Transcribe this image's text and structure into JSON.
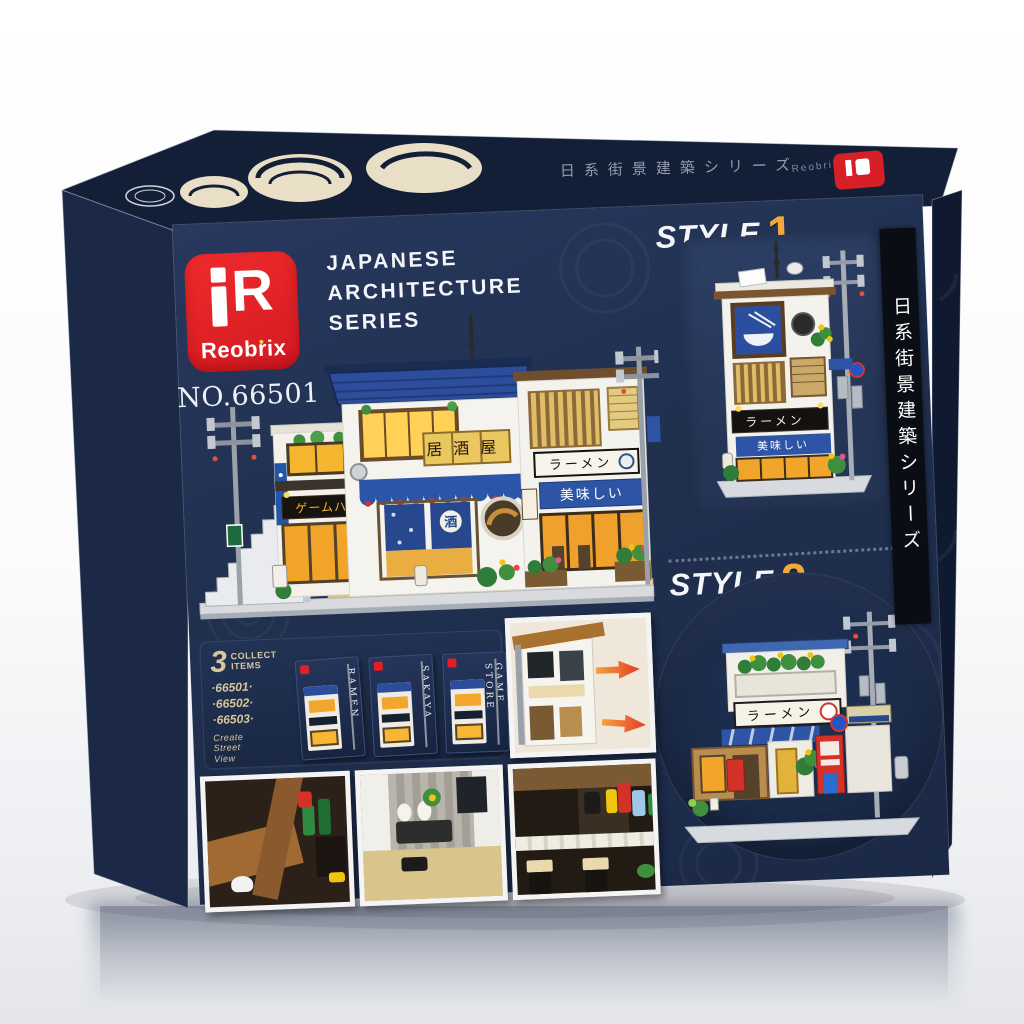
{
  "product": {
    "brand": "Reobrix",
    "logo_mark": "R",
    "product_no": "NO.66501",
    "series_title": "JAPANESE\nARCHITECTURE\nSERIES",
    "side_strip_text": "日系街景建築シリーズ",
    "lid_text": "日系街景建築シリーズ",
    "lid_brand": "Reobrix"
  },
  "styles": {
    "style1": {
      "label": "STYLE",
      "number": "1",
      "subtitle": "モデリング"
    },
    "style2": {
      "label": "STYLE",
      "number": "2",
      "subtitle": "モデリング"
    }
  },
  "signs": {
    "izakaya": "居酒屋",
    "ramen": "ラーメン",
    "oishii": "美味しい",
    "game_house": "ゲームハウス",
    "sake": "酒",
    "style1_ramen": "ラーメン",
    "style1_oishii": "美味しい",
    "style2_ramen": "ラーメン"
  },
  "collect": {
    "count": "3",
    "label": "COLLECT\nITEMS",
    "numbers": [
      "·66501·",
      "·66502·",
      "·66503·"
    ],
    "tagline": "Create\nStreet\nView"
  },
  "mini_boxes": [
    {
      "name": "RAMEN"
    },
    {
      "name": "SAKAYA"
    },
    {
      "name": "GAME STORE"
    }
  ],
  "colors": {
    "box_front": "#20304f",
    "box_left": "#1b2946",
    "box_lid": "#131e37",
    "box_right": "#0f1a30",
    "brand_red": "#e01f26",
    "accent_yellow": "#f2a93b",
    "cream_motif": "#e9dfc6"
  }
}
